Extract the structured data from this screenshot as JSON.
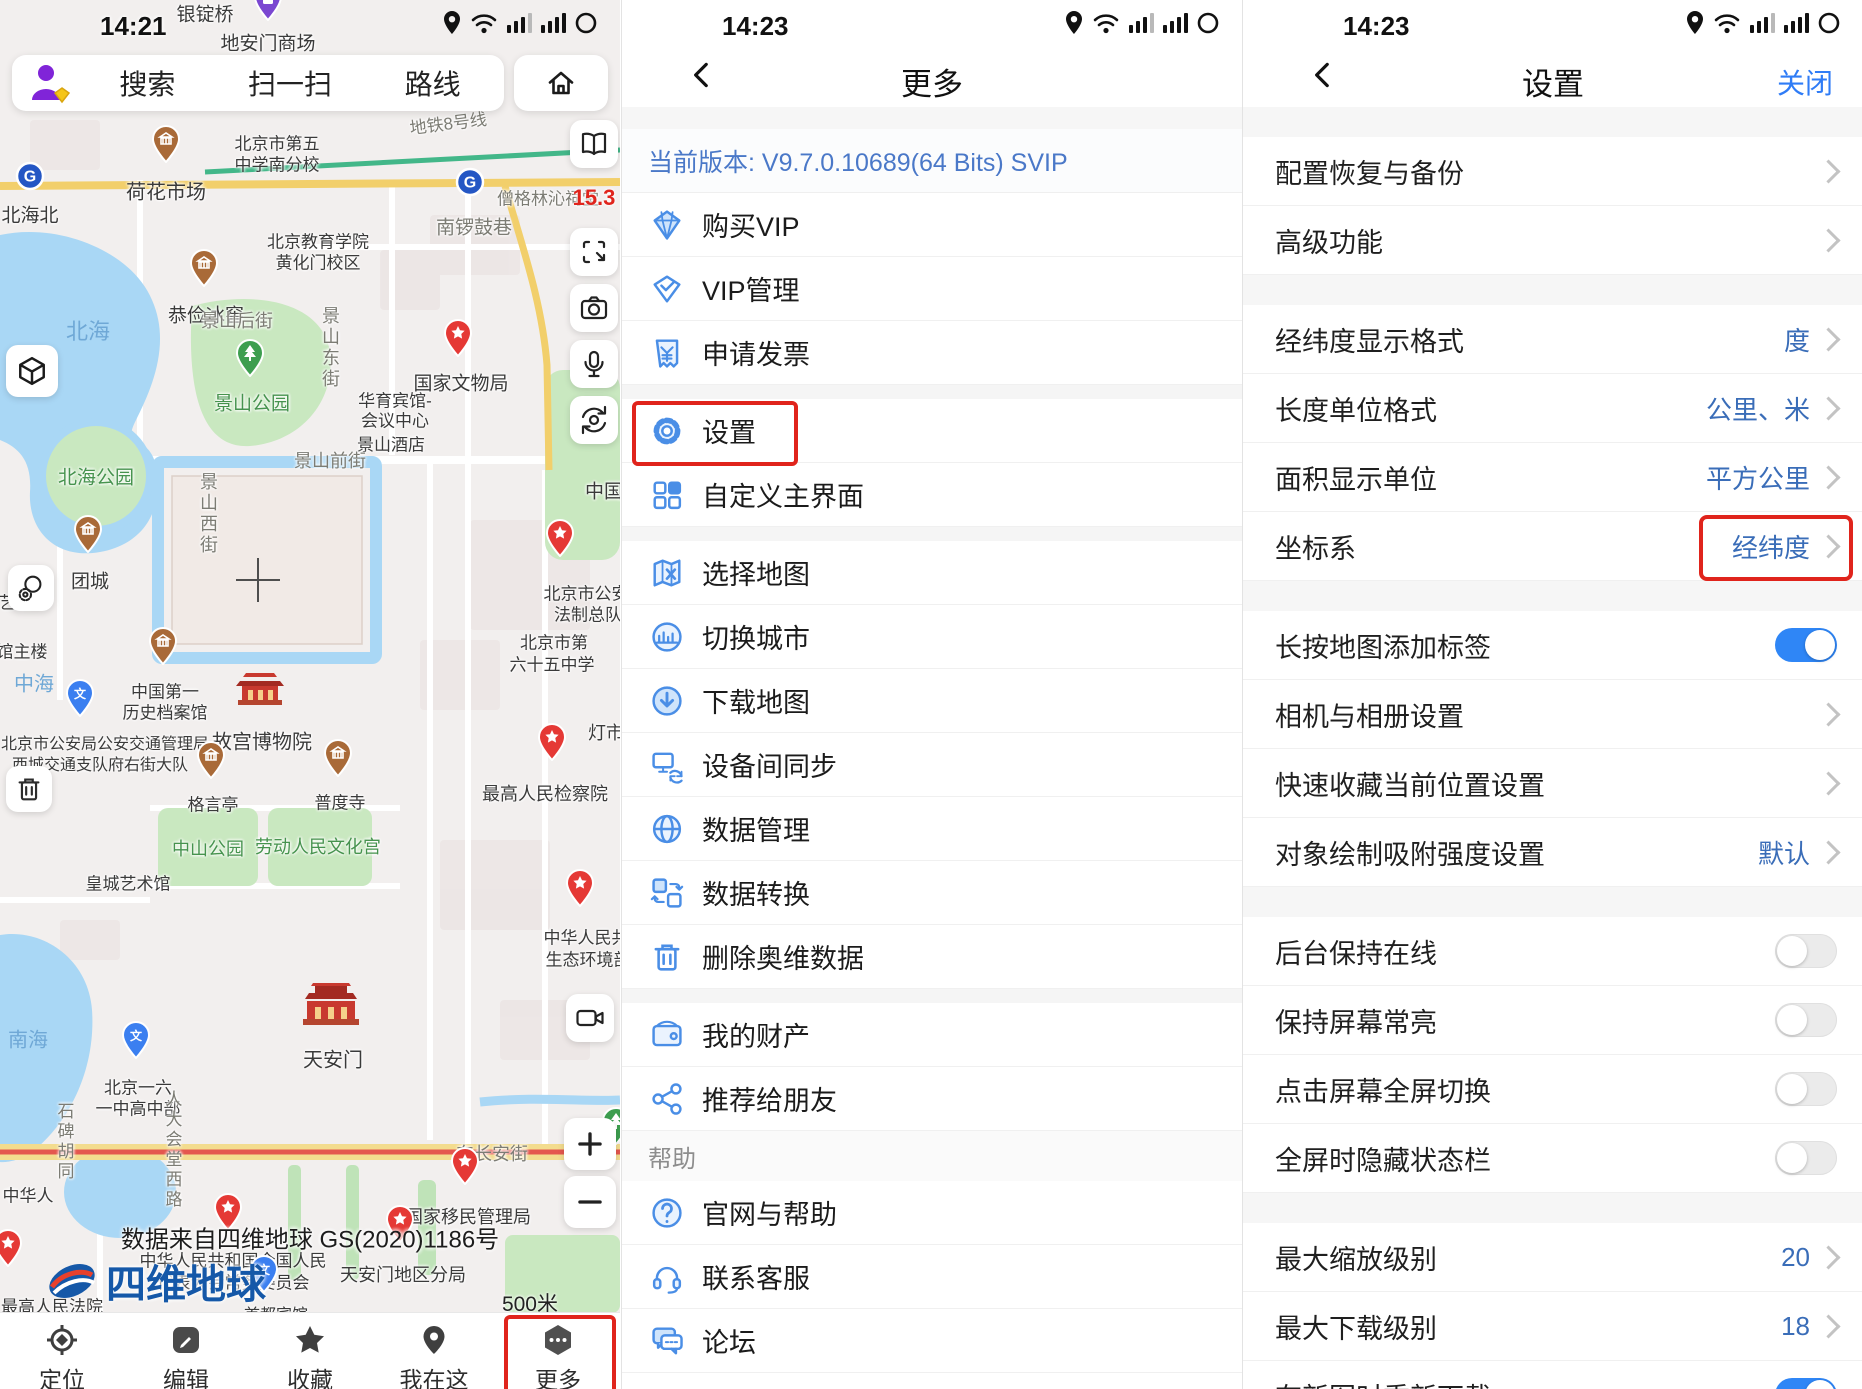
{
  "left": {
    "status": {
      "time": "14:21"
    },
    "search": {
      "items": [
        "搜索",
        "扫一扫",
        "路线"
      ]
    },
    "map": {
      "badge": "15.3",
      "attribution": "数据来自四维地球 GS(2020)1186号",
      "logo_text": "四维地球",
      "scale": "500米",
      "labels": [
        {
          "t": "银锭桥",
          "x": 205,
          "y": 13,
          "s": 19,
          "c": "lb-place"
        },
        {
          "t": "地安门商场",
          "x": 268,
          "y": 42,
          "s": 19,
          "c": "lb-place"
        },
        {
          "t": "荷花市场",
          "x": 166,
          "y": 190,
          "s": 20,
          "c": "lb-place"
        },
        {
          "t": "北海北",
          "x": 30,
          "y": 214,
          "s": 19,
          "c": "lb-place"
        },
        {
          "t": "地铁8号线",
          "x": 448,
          "y": 122,
          "s": 17,
          "c": "lb-road",
          "r": -7
        },
        {
          "t": "南锣鼓巷",
          "x": 474,
          "y": 226,
          "s": 19,
          "c": "lb-road"
        },
        {
          "t": "僧格林沁祠堂",
          "x": 548,
          "y": 197,
          "s": 17,
          "c": "lb-road"
        },
        {
          "t": "北京市第五",
          "x": 277,
          "y": 142,
          "s": 17,
          "c": "lb-place"
        },
        {
          "t": "中学南分校",
          "x": 277,
          "y": 163,
          "s": 17,
          "c": "lb-place"
        },
        {
          "t": "北京教育学院",
          "x": 318,
          "y": 240,
          "s": 17,
          "c": "lb-place"
        },
        {
          "t": "黄化门校区",
          "x": 318,
          "y": 261,
          "s": 17,
          "c": "lb-place"
        },
        {
          "t": "恭俭冰窖",
          "x": 206,
          "y": 314,
          "s": 19,
          "c": "lb-place"
        },
        {
          "t": "景山后街",
          "x": 237,
          "y": 320,
          "s": 18,
          "c": "lb-road"
        },
        {
          "t": "景山东街",
          "x": 330,
          "y": 348,
          "s": 18,
          "c": "lb-road",
          "v": 1
        },
        {
          "t": "景山公园",
          "x": 252,
          "y": 402,
          "s": 19,
          "c": "lb-park"
        },
        {
          "t": "景山西街",
          "x": 208,
          "y": 514,
          "s": 18,
          "c": "lb-road",
          "v": 1
        },
        {
          "t": "华育宾馆-",
          "x": 395,
          "y": 399,
          "s": 17,
          "c": "lb-place"
        },
        {
          "t": "会议中心",
          "x": 395,
          "y": 419,
          "s": 17,
          "c": "lb-place"
        },
        {
          "t": "景山酒店",
          "x": 391,
          "y": 443,
          "s": 17,
          "c": "lb-place"
        },
        {
          "t": "景山前街",
          "x": 330,
          "y": 460,
          "s": 18,
          "c": "lb-road"
        },
        {
          "t": "国家文物局",
          "x": 461,
          "y": 382,
          "s": 19,
          "c": "lb-place"
        },
        {
          "t": "中国",
          "x": 604,
          "y": 490,
          "s": 19,
          "c": "lb-place"
        },
        {
          "t": "北海",
          "x": 88,
          "y": 330,
          "s": 22,
          "c": "lb-water"
        },
        {
          "t": "北海公园",
          "x": 96,
          "y": 476,
          "s": 19,
          "c": "lb-park"
        },
        {
          "t": "团城",
          "x": 90,
          "y": 580,
          "s": 19,
          "c": "lb-place"
        },
        {
          "t": "艺楼",
          "x": 16,
          "y": 601,
          "s": 17,
          "c": "lb-place"
        },
        {
          "t": "馆主楼",
          "x": 22,
          "y": 650,
          "s": 17,
          "c": "lb-place"
        },
        {
          "t": "中海",
          "x": 34,
          "y": 682,
          "s": 20,
          "c": "lb-water"
        },
        {
          "t": "中国第一",
          "x": 165,
          "y": 690,
          "s": 17,
          "c": "lb-place"
        },
        {
          "t": "历史档案馆",
          "x": 165,
          "y": 711,
          "s": 17,
          "c": "lb-place"
        },
        {
          "t": "北京市公安局公安交通管理局",
          "x": 105,
          "y": 742,
          "s": 16,
          "c": "lb-place"
        },
        {
          "t": "西城交通支队府右街大队",
          "x": 100,
          "y": 763,
          "s": 16,
          "c": "lb-place"
        },
        {
          "t": "故宫博物院",
          "x": 262,
          "y": 740,
          "s": 20,
          "c": "lb-place"
        },
        {
          "t": "格言亭",
          "x": 213,
          "y": 803,
          "s": 17,
          "c": "lb-place"
        },
        {
          "t": "普度寺",
          "x": 340,
          "y": 801,
          "s": 17,
          "c": "lb-place"
        },
        {
          "t": "中山公园",
          "x": 208,
          "y": 848,
          "s": 18,
          "c": "lb-park"
        },
        {
          "t": "劳动人民文化宫",
          "x": 318,
          "y": 846,
          "s": 18,
          "c": "lb-park"
        },
        {
          "t": "皇城艺术馆",
          "x": 128,
          "y": 882,
          "s": 17,
          "c": "lb-place"
        },
        {
          "t": "北京市公安",
          "x": 586,
          "y": 592,
          "s": 17,
          "c": "lb-place"
        },
        {
          "t": "法制总队",
          "x": 588,
          "y": 613,
          "s": 17,
          "c": "lb-place"
        },
        {
          "t": "北京市第",
          "x": 554,
          "y": 641,
          "s": 17,
          "c": "lb-place"
        },
        {
          "t": "六十五中学",
          "x": 552,
          "y": 663,
          "s": 17,
          "c": "lb-place"
        },
        {
          "t": "灯市",
          "x": 606,
          "y": 732,
          "s": 18,
          "c": "lb-place"
        },
        {
          "t": "最高人民检察院",
          "x": 545,
          "y": 793,
          "s": 18,
          "c": "lb-place"
        },
        {
          "t": "中华人民共",
          "x": 586,
          "y": 936,
          "s": 17,
          "c": "lb-place"
        },
        {
          "t": "生态环境部",
          "x": 588,
          "y": 958,
          "s": 17,
          "c": "lb-place"
        },
        {
          "t": "南海",
          "x": 28,
          "y": 1038,
          "s": 20,
          "c": "lb-water"
        },
        {
          "t": "天安门",
          "x": 333,
          "y": 1058,
          "s": 20,
          "c": "lb-place"
        },
        {
          "t": "北京一六",
          "x": 138,
          "y": 1086,
          "s": 17,
          "c": "lb-place"
        },
        {
          "t": "一中高中部",
          "x": 138,
          "y": 1107,
          "s": 17,
          "c": "lb-place"
        },
        {
          "t": "石碑胡同",
          "x": 64,
          "y": 1142,
          "s": 17,
          "c": "lb-road",
          "v": 1
        },
        {
          "t": "人大会堂西路",
          "x": 172,
          "y": 1150,
          "s": 17,
          "c": "lb-road",
          "v": 1
        },
        {
          "t": "东长安街",
          "x": 492,
          "y": 1153,
          "s": 18,
          "c": "lb-road"
        },
        {
          "t": "国家移民管理局",
          "x": 468,
          "y": 1216,
          "s": 18,
          "c": "lb-place"
        },
        {
          "t": "中华人民共和国全国人民",
          "x": 233,
          "y": 1259,
          "s": 17,
          "c": "lb-place"
        },
        {
          "t": "代表大会常务委员会",
          "x": 233,
          "y": 1281,
          "s": 17,
          "c": "lb-place"
        },
        {
          "t": "天安门地区分局",
          "x": 403,
          "y": 1274,
          "s": 18,
          "c": "lb-place"
        },
        {
          "t": "中华人",
          "x": 28,
          "y": 1194,
          "s": 17,
          "c": "lb-place"
        },
        {
          "t": "最高人民法院",
          "x": 52,
          "y": 1305,
          "s": 17,
          "c": "lb-place"
        },
        {
          "t": "首都宾馆",
          "x": 276,
          "y": 1313,
          "s": 16,
          "c": "lb-place"
        }
      ],
      "pois": [
        {
          "k": "purple",
          "x": 268,
          "y": 26
        },
        {
          "k": "brown",
          "x": 166,
          "y": 168
        },
        {
          "k": "metro",
          "x": 30,
          "y": 196
        },
        {
          "k": "metro",
          "x": 470,
          "y": 202
        },
        {
          "k": "brown",
          "x": 204,
          "y": 292
        },
        {
          "k": "green",
          "x": 250,
          "y": 382
        },
        {
          "k": "redstar",
          "x": 458,
          "y": 362
        },
        {
          "k": "brown",
          "x": 88,
          "y": 558
        },
        {
          "k": "brown",
          "x": 163,
          "y": 670
        },
        {
          "k": "bluepin",
          "x": 80,
          "y": 722
        },
        {
          "k": "palace",
          "x": 260,
          "y": 712
        },
        {
          "k": "brown",
          "x": 211,
          "y": 784
        },
        {
          "k": "brown",
          "x": 338,
          "y": 782
        },
        {
          "k": "redstar",
          "x": 560,
          "y": 562
        },
        {
          "k": "redstar",
          "x": 552,
          "y": 766
        },
        {
          "k": "redstar",
          "x": 580,
          "y": 912
        },
        {
          "k": "gate",
          "x": 331,
          "y": 1032
        },
        {
          "k": "bluepin",
          "x": 136,
          "y": 1064
        },
        {
          "k": "redstar",
          "x": 465,
          "y": 1190
        },
        {
          "k": "redstar",
          "x": 228,
          "y": 1236
        },
        {
          "k": "redstar",
          "x": 400,
          "y": 1248
        },
        {
          "k": "bluepin",
          "x": 264,
          "y": 1298
        },
        {
          "k": "green",
          "x": 616,
          "y": 1150
        },
        {
          "k": "redstar",
          "x": 8,
          "y": 1272
        }
      ]
    },
    "controls": [
      {
        "icon": "book",
        "x": 570,
        "y": 120,
        "w": 48,
        "h": 48
      },
      {
        "icon": "screenshot",
        "x": 570,
        "y": 228,
        "w": 48,
        "h": 48
      },
      {
        "icon": "camera",
        "x": 570,
        "y": 284,
        "w": 48,
        "h": 48
      },
      {
        "icon": "mic",
        "x": 570,
        "y": 340,
        "w": 48,
        "h": 48
      },
      {
        "icon": "rotatecam",
        "x": 570,
        "y": 396,
        "w": 48,
        "h": 48
      },
      {
        "icon": "cube",
        "x": 6,
        "y": 345,
        "w": 52,
        "h": 52
      },
      {
        "icon": "modes",
        "x": 8,
        "y": 565,
        "w": 46,
        "h": 46
      },
      {
        "icon": "trash2",
        "x": 6,
        "y": 766,
        "w": 46,
        "h": 46
      },
      {
        "icon": "video",
        "x": 566,
        "y": 994,
        "w": 48,
        "h": 48
      },
      {
        "icon": "plus",
        "x": 564,
        "y": 1118,
        "w": 52,
        "h": 52
      },
      {
        "icon": "minus",
        "x": 564,
        "y": 1176,
        "w": 52,
        "h": 52
      }
    ],
    "nav": [
      {
        "icon": "locate",
        "label": "定位"
      },
      {
        "icon": "edit",
        "label": "编辑"
      },
      {
        "icon": "star",
        "label": "收藏"
      },
      {
        "icon": "pin",
        "label": "我在这"
      },
      {
        "icon": "more",
        "label": "更多",
        "highlight": true
      }
    ]
  },
  "middle": {
    "status": {
      "time": "14:23"
    },
    "header": {
      "title": "更多"
    },
    "version": "当前版本: V9.7.0.10689(64 Bits) SVIP",
    "rows": [
      {
        "icon": "diamond",
        "label": "购买VIP"
      },
      {
        "icon": "diamond2",
        "label": "VIP管理"
      },
      {
        "icon": "invoice",
        "label": "申请发票"
      },
      {
        "type": "band"
      },
      {
        "icon": "gear",
        "label": "设置",
        "highlight": true
      },
      {
        "icon": "grid",
        "label": "自定义主界面"
      },
      {
        "type": "band"
      },
      {
        "icon": "mappick",
        "label": "选择地图"
      },
      {
        "icon": "city",
        "label": "切换城市"
      },
      {
        "icon": "download",
        "label": "下载地图"
      },
      {
        "icon": "sync",
        "label": "设备间同步"
      },
      {
        "icon": "globe",
        "label": "数据管理"
      },
      {
        "icon": "convert",
        "label": "数据转换"
      },
      {
        "icon": "trash",
        "label": "删除奥维数据"
      },
      {
        "type": "band"
      },
      {
        "icon": "wallet",
        "label": "我的财产"
      },
      {
        "icon": "share",
        "label": "推荐给朋友"
      },
      {
        "type": "header",
        "label": "帮助"
      },
      {
        "icon": "question",
        "label": "官网与帮助"
      },
      {
        "icon": "headset",
        "label": "联系客服"
      },
      {
        "icon": "forum",
        "label": "论坛"
      },
      {
        "icon": "shield",
        "label": "隐私与服务协议"
      }
    ]
  },
  "right": {
    "status": {
      "time": "14:23"
    },
    "header": {
      "title": "设置",
      "close": "关闭"
    },
    "rows": [
      {
        "type": "band"
      },
      {
        "label": "配置恢复与备份",
        "control": "chevron"
      },
      {
        "label": "高级功能",
        "control": "chevron"
      },
      {
        "type": "band"
      },
      {
        "label": "经纬度显示格式",
        "value": "度",
        "control": "chevron"
      },
      {
        "label": "长度单位格式",
        "value": "公里、米",
        "control": "chevron"
      },
      {
        "label": "面积显示单位",
        "value": "平方公里",
        "control": "chevron"
      },
      {
        "label": "坐标系",
        "value": "经纬度",
        "control": "chevron",
        "highlight": true
      },
      {
        "type": "band"
      },
      {
        "label": "长按地图添加标签",
        "control": "toggle",
        "on": true
      },
      {
        "label": "相机与相册设置",
        "control": "chevron"
      },
      {
        "label": "快速收藏当前位置设置",
        "control": "chevron"
      },
      {
        "label": "对象绘制吸附强度设置",
        "value": "默认",
        "control": "chevron"
      },
      {
        "type": "band"
      },
      {
        "label": "后台保持在线",
        "control": "toggle",
        "on": false
      },
      {
        "label": "保持屏幕常亮",
        "control": "toggle",
        "on": false
      },
      {
        "label": "点击屏幕全屏切换",
        "control": "toggle",
        "on": false
      },
      {
        "label": "全屏时隐藏状态栏",
        "control": "toggle",
        "on": false
      },
      {
        "type": "band"
      },
      {
        "label": "最大缩放级别",
        "value": "20",
        "control": "chevron"
      },
      {
        "label": "最大下载级别",
        "value": "18",
        "control": "chevron"
      },
      {
        "label": "有新图时重新下载",
        "control": "toggle",
        "on": true
      }
    ]
  },
  "colors": {
    "accent_blue": "#4a8ee6",
    "highlight_red": "#e0241c",
    "toggle_on": "#2f86f6",
    "link_blue": "#2f7cf6"
  }
}
